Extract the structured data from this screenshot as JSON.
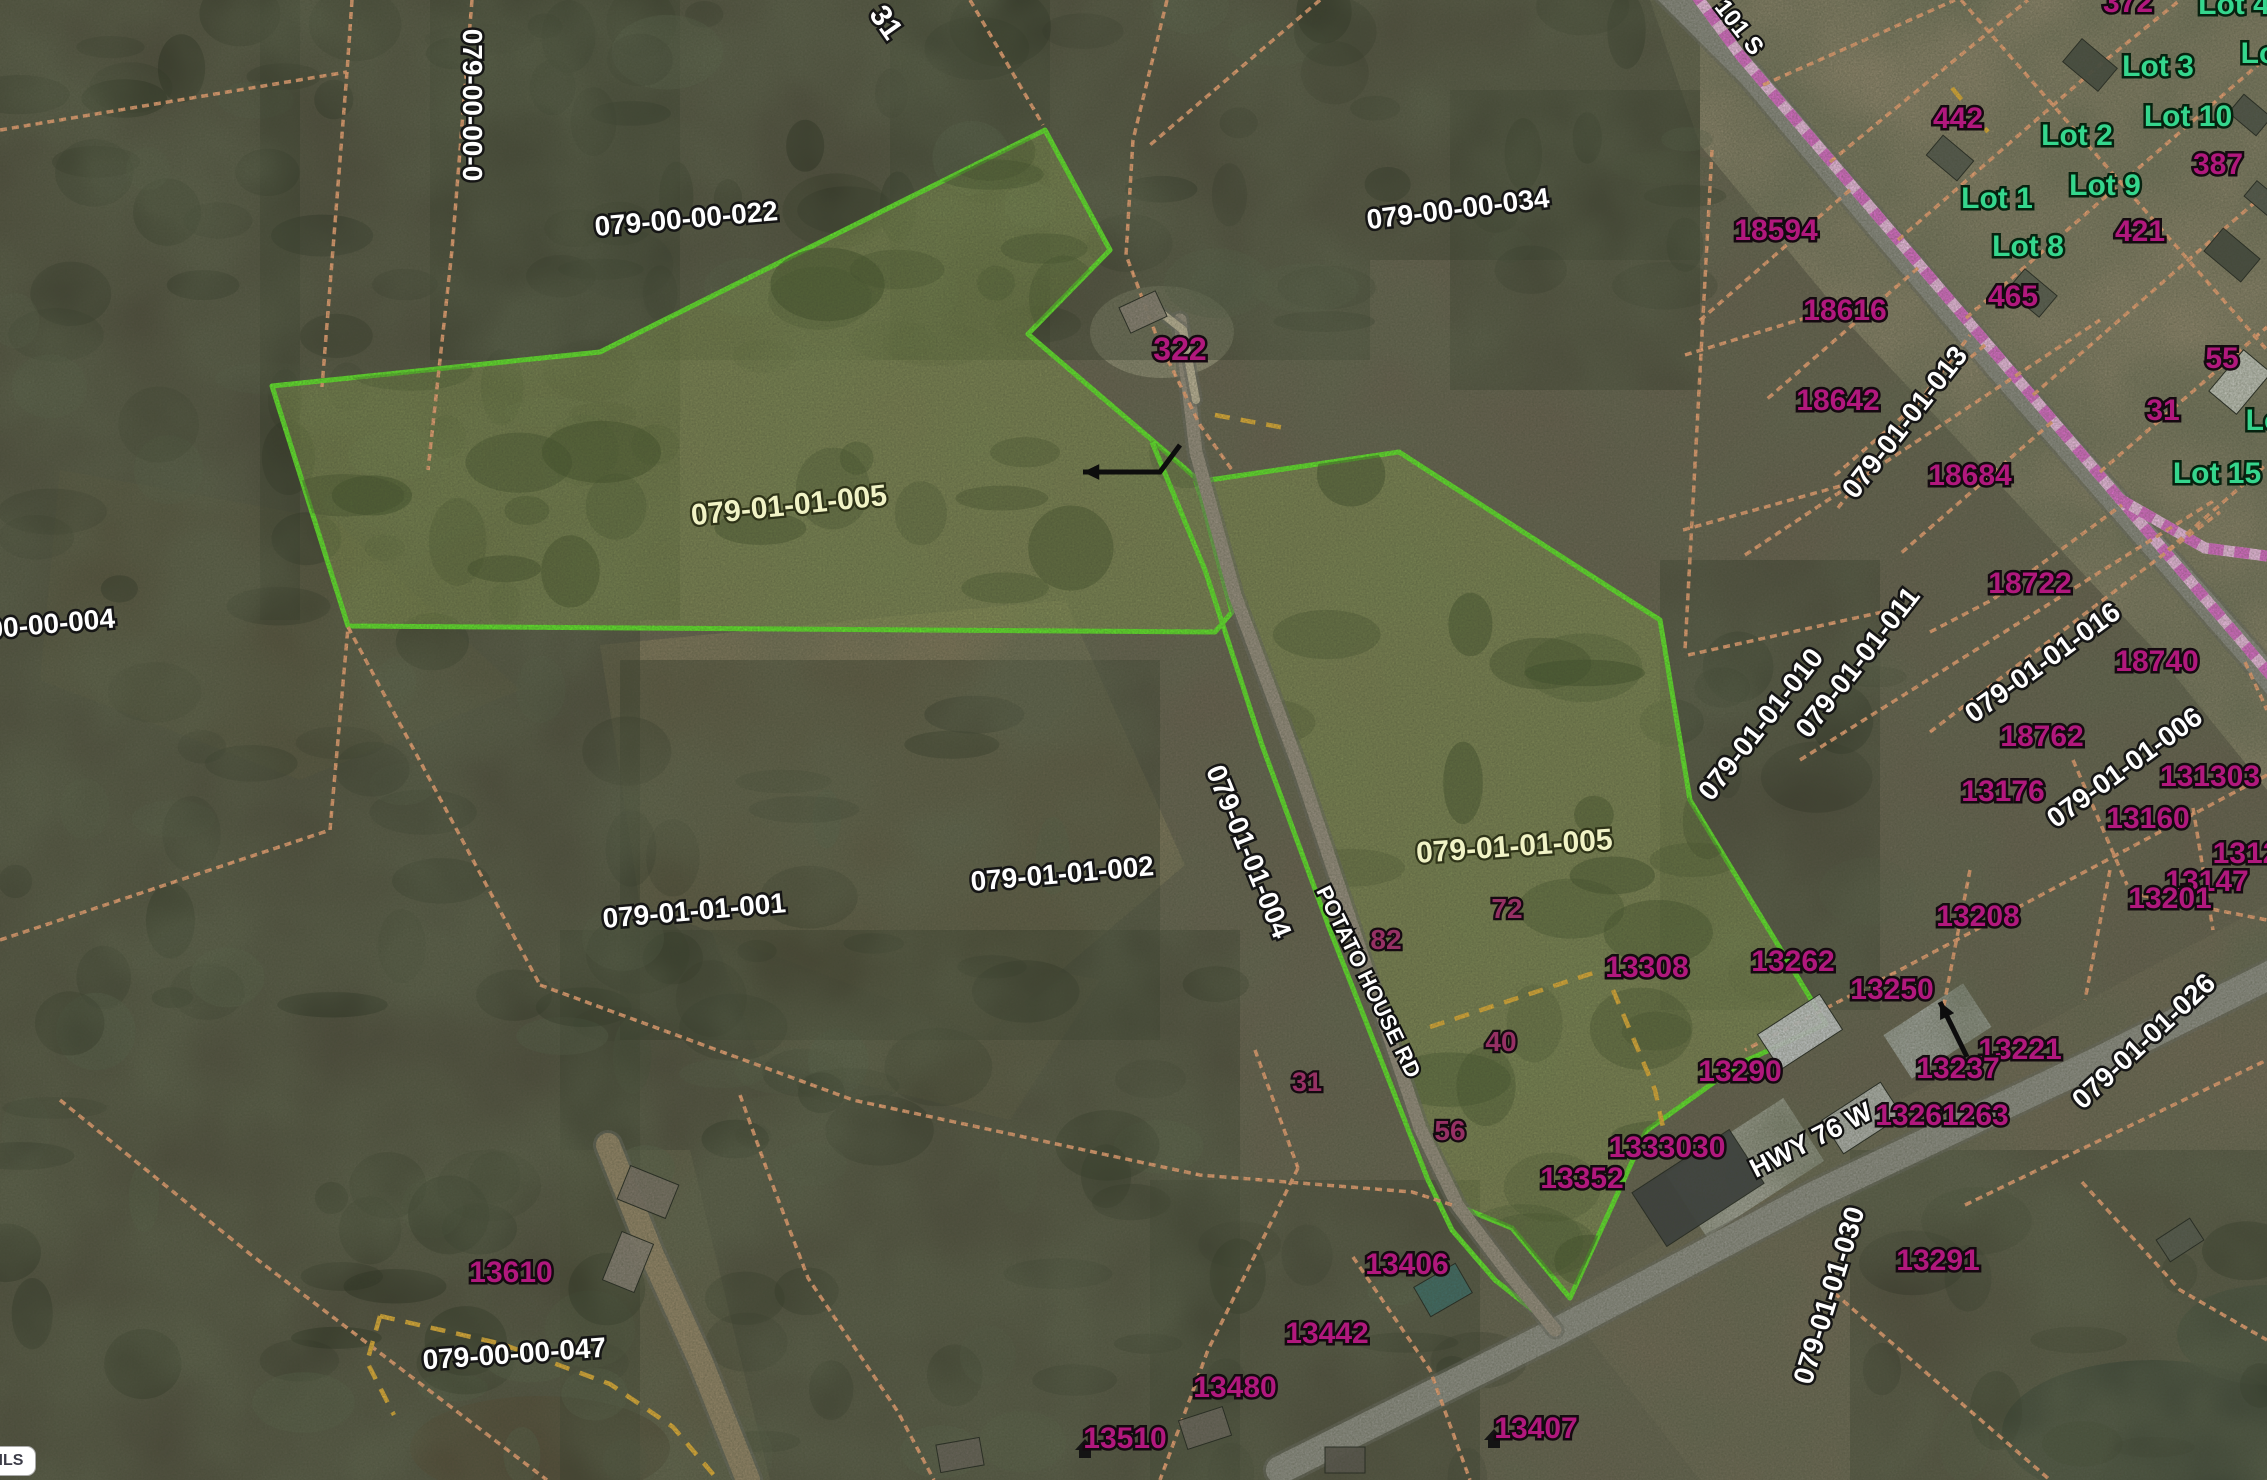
{
  "app": {
    "watermark": "ggarMLS"
  },
  "map": {
    "width": 2267,
    "height": 1480,
    "colors": {
      "highlight_green": "#62ed2b",
      "parcel_fill": "#8fa455",
      "orange_line": "#f5a878",
      "pink_line_base": "#f7c3ec",
      "pink_line_dash": "#e26fd0",
      "yellow_dash": "#e7b238",
      "address_magenta": "#b1187d",
      "lot_green": "#35d68d",
      "road_gray": "#8e8e86"
    },
    "labels": {
      "parcels_white": [
        {
          "text": "079-00-00-022",
          "x": 687,
          "y": 228,
          "rot": -5,
          "size": 28
        },
        {
          "text": "079-00-00-0",
          "x": 463,
          "y": 105,
          "rot": 90,
          "size": 28
        },
        {
          "text": "31",
          "x": 878,
          "y": 28,
          "rot": 55,
          "size": 30
        },
        {
          "text": "079-00-00-034",
          "x": 1459,
          "y": 218,
          "rot": -7,
          "size": 28
        },
        {
          "text": "079-01-01-001",
          "x": 695,
          "y": 920,
          "rot": -5,
          "size": 28
        },
        {
          "text": "079-01-01-002",
          "x": 1063,
          "y": 883,
          "rot": -5,
          "size": 28
        },
        {
          "text": "079-01-01-004",
          "x": 1240,
          "y": 855,
          "rot": 68,
          "size": 28
        },
        {
          "text": "079-01-01-013",
          "x": 1912,
          "y": 428,
          "rot": -52,
          "size": 28
        },
        {
          "text": "079-01-01-011",
          "x": 1865,
          "y": 668,
          "rot": -52,
          "size": 28
        },
        {
          "text": "079-01-01-010",
          "x": 1768,
          "y": 730,
          "rot": -52,
          "size": 28
        },
        {
          "text": "079-01-01-016",
          "x": 2048,
          "y": 670,
          "rot": -36,
          "size": 28
        },
        {
          "text": "079-01-01-006",
          "x": 2130,
          "y": 775,
          "rot": -36,
          "size": 28
        },
        {
          "text": "079-01-01-026",
          "x": 2150,
          "y": 1048,
          "rot": -43,
          "size": 28
        },
        {
          "text": "079-01-01-030",
          "x": 1838,
          "y": 1298,
          "rot": -73,
          "size": 28
        },
        {
          "text": "00-00-004",
          "x": 52,
          "y": 633,
          "rot": -5,
          "size": 28
        },
        {
          "text": "079-00-00-047",
          "x": 515,
          "y": 1363,
          "rot": -4,
          "size": 28
        }
      ],
      "parcels_cream": [
        {
          "text": "079-01-01-005",
          "x": 790,
          "y": 515,
          "rot": -6,
          "size": 30
        },
        {
          "text": "079-01-01-005",
          "x": 1515,
          "y": 856,
          "rot": -4,
          "size": 30
        }
      ],
      "addresses": [
        {
          "text": "322",
          "x": 1180,
          "y": 360,
          "size": 32
        },
        {
          "text": "372",
          "x": 2128,
          "y": 12,
          "size": 30
        },
        {
          "text": "442",
          "x": 1958,
          "y": 128,
          "size": 30
        },
        {
          "text": "387",
          "x": 2218,
          "y": 174,
          "size": 30
        },
        {
          "text": "421",
          "x": 2140,
          "y": 241,
          "size": 30
        },
        {
          "text": "465",
          "x": 2013,
          "y": 306,
          "size": 30
        },
        {
          "text": "55",
          "x": 2222,
          "y": 368,
          "size": 30
        },
        {
          "text": "31",
          "x": 2163,
          "y": 420,
          "size": 30
        },
        {
          "text": "18594",
          "x": 1776,
          "y": 240,
          "size": 30
        },
        {
          "text": "18616",
          "x": 1845,
          "y": 320,
          "size": 30
        },
        {
          "text": "18642",
          "x": 1838,
          "y": 410,
          "size": 30
        },
        {
          "text": "18684",
          "x": 1970,
          "y": 485,
          "size": 30
        },
        {
          "text": "18722",
          "x": 2030,
          "y": 593,
          "size": 30
        },
        {
          "text": "18740",
          "x": 2157,
          "y": 671,
          "size": 30
        },
        {
          "text": "18762",
          "x": 2042,
          "y": 746,
          "size": 30
        },
        {
          "text": "13176",
          "x": 2003,
          "y": 801,
          "size": 30
        },
        {
          "text": "131303",
          "x": 2210,
          "y": 786,
          "size": 30
        },
        {
          "text": "13160",
          "x": 2148,
          "y": 828,
          "size": 30
        },
        {
          "text": "1312",
          "x": 2246,
          "y": 863,
          "size": 30
        },
        {
          "text": "13147",
          "x": 2207,
          "y": 891,
          "size": 30
        },
        {
          "text": "13201",
          "x": 2170,
          "y": 908,
          "size": 30
        },
        {
          "text": "13208",
          "x": 1978,
          "y": 926,
          "size": 30
        },
        {
          "text": "13262",
          "x": 1793,
          "y": 971,
          "size": 30
        },
        {
          "text": "13250",
          "x": 1892,
          "y": 999,
          "size": 30
        },
        {
          "text": "13221",
          "x": 2020,
          "y": 1059,
          "size": 30
        },
        {
          "text": "13237",
          "x": 1958,
          "y": 1078,
          "size": 30
        },
        {
          "text": "13290",
          "x": 1740,
          "y": 1081,
          "size": 30
        },
        {
          "text": "13261263",
          "x": 1942,
          "y": 1125,
          "size": 30
        },
        {
          "text": "13291",
          "x": 1938,
          "y": 1270,
          "size": 30
        },
        {
          "text": "13308",
          "x": 1647,
          "y": 977,
          "size": 30
        },
        {
          "text": "1333030",
          "x": 1667,
          "y": 1157,
          "size": 30
        },
        {
          "text": "13352",
          "x": 1582,
          "y": 1188,
          "size": 30
        },
        {
          "text": "13406",
          "x": 1407,
          "y": 1274,
          "size": 30
        },
        {
          "text": "13442",
          "x": 1327,
          "y": 1343,
          "size": 30
        },
        {
          "text": "13480",
          "x": 1235,
          "y": 1397,
          "size": 30
        },
        {
          "text": "13510",
          "x": 1125,
          "y": 1448,
          "size": 30
        },
        {
          "text": "13407",
          "x": 1536,
          "y": 1438,
          "size": 30
        },
        {
          "text": "13610",
          "x": 511,
          "y": 1282,
          "size": 30
        }
      ],
      "addresses_dim": [
        {
          "text": "82",
          "x": 1386,
          "y": 949,
          "size": 28
        },
        {
          "text": "72",
          "x": 1507,
          "y": 918,
          "size": 28
        },
        {
          "text": "40",
          "x": 1501,
          "y": 1051,
          "size": 28
        },
        {
          "text": "56",
          "x": 1450,
          "y": 1140,
          "size": 28
        },
        {
          "text": "31",
          "x": 1307,
          "y": 1091,
          "size": 27
        }
      ],
      "lots": [
        {
          "text": "Lot 3",
          "x": 2158,
          "y": 76,
          "size": 30
        },
        {
          "text": "Lot 4",
          "x": 2234,
          "y": 14,
          "size": 30
        },
        {
          "text": "Lot",
          "x": 2264,
          "y": 63,
          "size": 30
        },
        {
          "text": "Lot 2",
          "x": 2077,
          "y": 145,
          "size": 30
        },
        {
          "text": "Lot 10",
          "x": 2188,
          "y": 126,
          "size": 30
        },
        {
          "text": "Lot 1",
          "x": 1997,
          "y": 208,
          "size": 30
        },
        {
          "text": "Lot 9",
          "x": 2105,
          "y": 195,
          "size": 30
        },
        {
          "text": "Lot 8",
          "x": 2028,
          "y": 256,
          "size": 30
        },
        {
          "text": "Lot 15",
          "x": 2217,
          "y": 483,
          "size": 30
        },
        {
          "text": "Lo",
          "x": 2264,
          "y": 430,
          "size": 30
        }
      ],
      "roads": [
        {
          "text": "101 S",
          "x": 1733,
          "y": 32,
          "rot": 52,
          "size": 24
        },
        {
          "text": "POTATO HOUSE RD",
          "x": 1362,
          "y": 985,
          "rot": 64,
          "size": 22
        },
        {
          "text": "HWY 76 W",
          "x": 1815,
          "y": 1148,
          "rot": -27,
          "size": 27
        }
      ]
    },
    "highlighted_parcels": [
      {
        "id": "parcel-005-west",
        "points": "272,386 600,352 1045,130 1110,250 1028,334 1152,440 1196,478 1232,612 1215,632 348,626"
      },
      {
        "id": "parcel-005-east",
        "points": "1196,482 1399,452 1660,620 1690,800 1826,1024 1741,1063 1646,1131 1570,1298 1512,1228 1458,1206 1420,1128 1372,985 1300,770 1235,595"
      }
    ],
    "green_lines": [
      {
        "points": "1152,442 1205,570 1262,745 1330,930 1385,1070 1428,1180 1452,1230 1495,1280 1548,1322"
      }
    ],
    "roads_geo": [
      {
        "points": "1655,-20 1750,75 2000,370 2250,655 2300,715",
        "w": 24,
        "color": "#8e8e86"
      },
      {
        "points": "2300,960 2100,1060 1815,1195 1560,1330 1280,1470",
        "w": 28,
        "color": "#92928a"
      },
      {
        "points": "1180,320 1196,452 1235,595 1300,770 1372,985 1420,1128 1458,1206 1510,1275 1555,1330",
        "w": 13,
        "color": "#9a9183"
      },
      {
        "points": "608,1145 652,1255 700,1360 748,1480",
        "w": 24,
        "color": "#96876a"
      },
      {
        "points": "1160,312 1183,330 1196,400",
        "w": 8,
        "color": "#c2b89d"
      }
    ],
    "pink_lines": [
      {
        "points": "1692,-10 1740,55 2245,645 2300,710"
      },
      {
        "points": "2118,498 2205,548 2267,556"
      }
    ],
    "orange_lines": [
      {
        "points": "472,0 452,250 428,470"
      },
      {
        "points": "352,0 347,72 322,387"
      },
      {
        "points": "0,130 347,72"
      },
      {
        "points": "970,0 1043,125"
      },
      {
        "points": "1167,0 1133,140 1126,255 1158,340 1200,425 1232,470"
      },
      {
        "points": "1320,0 1150,145"
      },
      {
        "points": "1930,732 2103,600 2220,512"
      },
      {
        "points": "1930,632 1992,600 2122,505"
      },
      {
        "points": "2073,760 2127,885"
      },
      {
        "points": "2193,808 2213,930"
      },
      {
        "points": "2130,893 2267,920"
      },
      {
        "points": "2245,662 2267,710"
      },
      {
        "points": "1838,508 1970,335"
      },
      {
        "points": "1745,555 2100,320"
      },
      {
        "points": "1800,760 2215,500"
      },
      {
        "points": "1763,85 1955,0"
      },
      {
        "points": "1830,162 2028,0"
      },
      {
        "points": "1898,240 2096,68 2180,0"
      },
      {
        "points": "1966,318 2164,146 2267,57"
      },
      {
        "points": "2033,395 2231,223 2267,192"
      },
      {
        "points": "2100,472 2267,327"
      },
      {
        "points": "2168,550 2267,464"
      },
      {
        "points": "1961,0 2121,183 2267,350"
      },
      {
        "points": "1850,190 1698,322"
      },
      {
        "points": "1918,268 1766,400"
      },
      {
        "points": "1985,345 1833,477"
      },
      {
        "points": "2052,422 1900,554"
      },
      {
        "points": "1712,150 1685,650"
      },
      {
        "points": "1685,355 1838,308"
      },
      {
        "points": "1683,530 1862,480"
      },
      {
        "points": "1688,655 1905,607"
      },
      {
        "points": "2267,775 1900,970 1745,1050"
      },
      {
        "points": "1970,870 1943,1010"
      },
      {
        "points": "2110,870 2085,1000"
      },
      {
        "points": "1965,1205 2267,1060"
      },
      {
        "points": "1825,1285 2050,1480"
      },
      {
        "points": "2082,1182 2180,1290 2267,1340"
      },
      {
        "points": "540,985 853,1100 1200,1175 1412,1192 1452,1205"
      },
      {
        "points": "1255,1050 1298,1168"
      },
      {
        "points": "1298,1168 1208,1350 1160,1480"
      },
      {
        "points": "1353,1257 1430,1370 1470,1480"
      },
      {
        "points": "0,940 330,830 348,627"
      },
      {
        "points": "60,1100 250,1254 547,1480"
      },
      {
        "points": "348,627 540,985"
      },
      {
        "points": "740,1095 767,1170 808,1278 898,1412 934,1480"
      }
    ],
    "yellow_lines": [
      {
        "points": "380,1316 502,1344 610,1384 673,1427 718,1480"
      },
      {
        "points": "380,1316 367,1362 394,1415"
      },
      {
        "points": "1215,415 1285,428"
      },
      {
        "points": "1430,1027 1593,973"
      },
      {
        "points": "1613,990 1655,1090 1668,1150"
      },
      {
        "points": "1952,88 1988,132"
      }
    ],
    "patches": [
      {
        "type": "poly",
        "points": "1650,0 2267,0 2267,790 2150,645 1850,325 1700,145",
        "fill": "#998d74",
        "op": 0.95
      },
      {
        "type": "poly",
        "points": "600,645 1065,600 1185,865 985,1035 640,905",
        "fill": "#8d7e60",
        "op": 0.9
      },
      {
        "type": "poly",
        "points": "700,900 1100,980 1010,1120 760,1060",
        "fill": "#83765b",
        "op": 0.7
      },
      {
        "type": "poly",
        "points": "1560,1300 1900,1100 2267,905 2267,1480 1700,1480",
        "fill": "#80745f",
        "op": 0.55
      },
      {
        "type": "poly",
        "points": "560,1150 690,1150 770,1480 560,1480",
        "fill": "#93866b",
        "op": 0.85
      },
      {
        "type": "poly",
        "points": "60,470 335,520 520,690 300,780 40,680",
        "fill": "#7b6d54",
        "op": 0.75
      },
      {
        "type": "ellipse",
        "x": 540,
        "y": 1448,
        "rx": 130,
        "ry": 52,
        "fill": "#6d5440",
        "op": 1
      },
      {
        "type": "ellipse",
        "x": 2152,
        "y": 1432,
        "rx": 150,
        "ry": 72,
        "fill": "#39443c",
        "op": 1
      },
      {
        "type": "ellipse",
        "x": 2267,
        "y": 1335,
        "rx": 90,
        "ry": 50,
        "fill": "#495549",
        "op": 0.8
      },
      {
        "type": "ellipse",
        "x": 1162,
        "y": 332,
        "rx": 72,
        "ry": 46,
        "fill": "#b4aa90",
        "op": 0.9
      },
      {
        "type": "rect",
        "x": 1675,
        "y": 1130,
        "w": 140,
        "h": 75,
        "rot": -33,
        "fill": "#c6c6c0",
        "op": 0.9
      },
      {
        "type": "rect",
        "x": 1890,
        "y": 1005,
        "w": 95,
        "h": 52,
        "rot": -33,
        "fill": "#c3c6c7",
        "op": 0.9
      }
    ],
    "forest_regions": [
      [
        0,
        0,
        300,
        1480,
        9000
      ],
      [
        260,
        0,
        420,
        620,
        9000
      ],
      [
        300,
        620,
        340,
        860,
        9000
      ],
      [
        430,
        0,
        620,
        360,
        10000
      ],
      [
        890,
        0,
        480,
        360,
        9000
      ],
      [
        1370,
        0,
        330,
        260,
        10000
      ],
      [
        1450,
        90,
        250,
        300,
        11000
      ],
      [
        1660,
        560,
        220,
        450,
        10000
      ],
      [
        560,
        930,
        680,
        550,
        8500
      ],
      [
        1150,
        1180,
        330,
        300,
        10000
      ],
      [
        1850,
        1150,
        420,
        330,
        11000
      ],
      [
        620,
        660,
        540,
        380,
        14000
      ]
    ],
    "parcel_clump_regions": [
      {
        "clip": "clip-west",
        "bbox": [
          300,
          150,
          900,
          470
        ],
        "n": 34
      },
      {
        "clip": "clip-east",
        "bbox": [
          1210,
          470,
          610,
          800
        ],
        "n": 30
      }
    ],
    "buildings": [
      [
        1143,
        312,
        40,
        28,
        -25,
        "#8d8579"
      ],
      [
        2090,
        65,
        46,
        30,
        40,
        "#4a4f45"
      ],
      [
        1950,
        158,
        40,
        26,
        40,
        "#565b50"
      ],
      [
        2250,
        115,
        36,
        24,
        40,
        "#50554b"
      ],
      [
        2032,
        293,
        42,
        28,
        40,
        "#5a5f53"
      ],
      [
        2232,
        255,
        48,
        30,
        40,
        "#474c42"
      ],
      [
        2240,
        382,
        54,
        36,
        -50,
        "#c9cdc4"
      ],
      [
        2262,
        198,
        30,
        20,
        40,
        "#555a50"
      ],
      [
        1800,
        1032,
        74,
        42,
        -33,
        "#cdd0d2"
      ],
      [
        1698,
        1188,
        116,
        64,
        -33,
        "#3e4142"
      ],
      [
        1862,
        1118,
        70,
        40,
        -33,
        "#b9bcb8"
      ],
      [
        1443,
        1290,
        48,
        34,
        -30,
        "#3f6f6a"
      ],
      [
        648,
        1192,
        52,
        36,
        22,
        "#7d756a"
      ],
      [
        628,
        1262,
        34,
        52,
        22,
        "#8a8277"
      ],
      [
        1205,
        1428,
        46,
        30,
        -18,
        "#6e6960"
      ],
      [
        1345,
        1460,
        40,
        26,
        0,
        "#5d5952"
      ],
      [
        960,
        1455,
        44,
        28,
        -10,
        "#6a655c"
      ],
      [
        2180,
        1240,
        40,
        26,
        -33,
        "#585d52"
      ]
    ],
    "house_icons": [
      [
        1085,
        1448
      ],
      [
        1494,
        1438
      ]
    ],
    "arrows": [
      {
        "points": "1967,1057 1940,1002",
        "tip": [
          1940,
          1002
        ]
      },
      {
        "points": "1180,445 1160,472 1083,472",
        "tip": [
          1083,
          472
        ]
      }
    ]
  }
}
